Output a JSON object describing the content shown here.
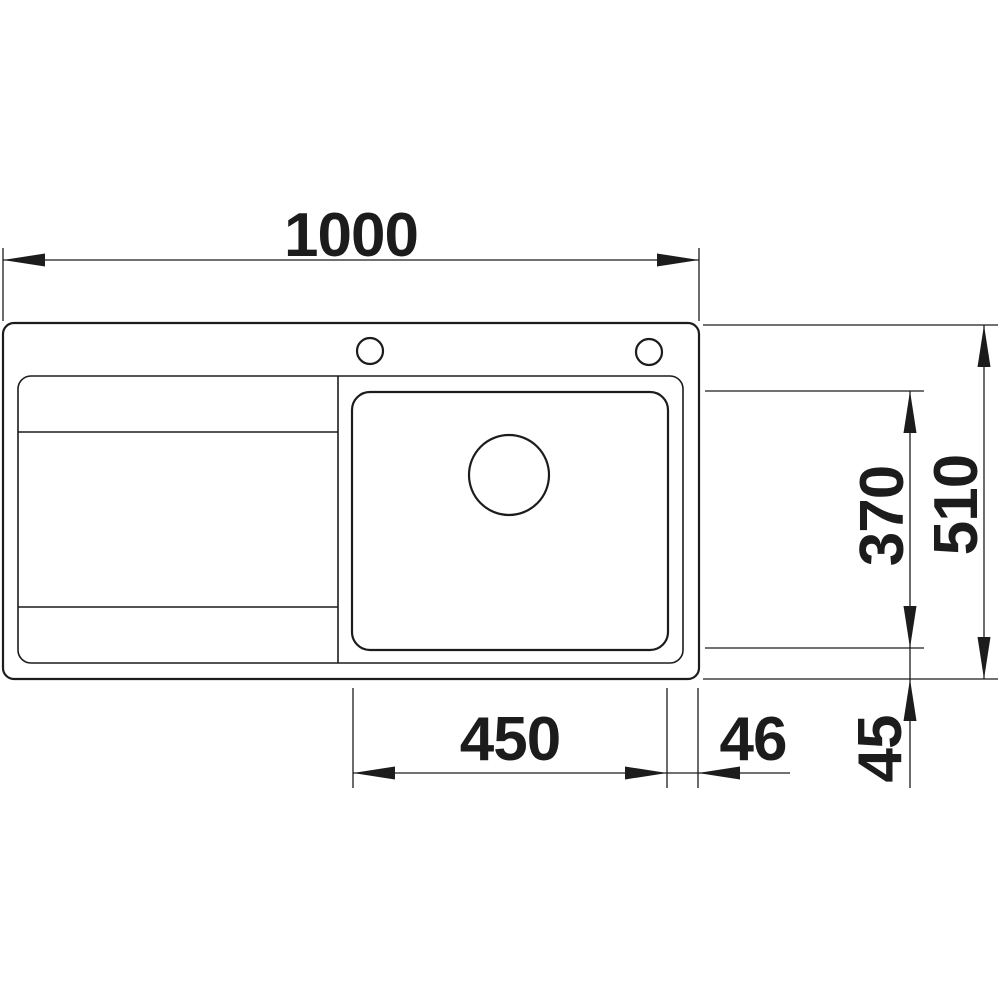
{
  "drawing": {
    "background": "#ffffff",
    "line_color": "#1c1c1c",
    "labels": {
      "overall_width": "1000",
      "overall_depth": "510",
      "bowl_depth": "370",
      "bowl_width": "450",
      "bowl_right_offset": "46",
      "bowl_bottom_offset": "45"
    }
  }
}
